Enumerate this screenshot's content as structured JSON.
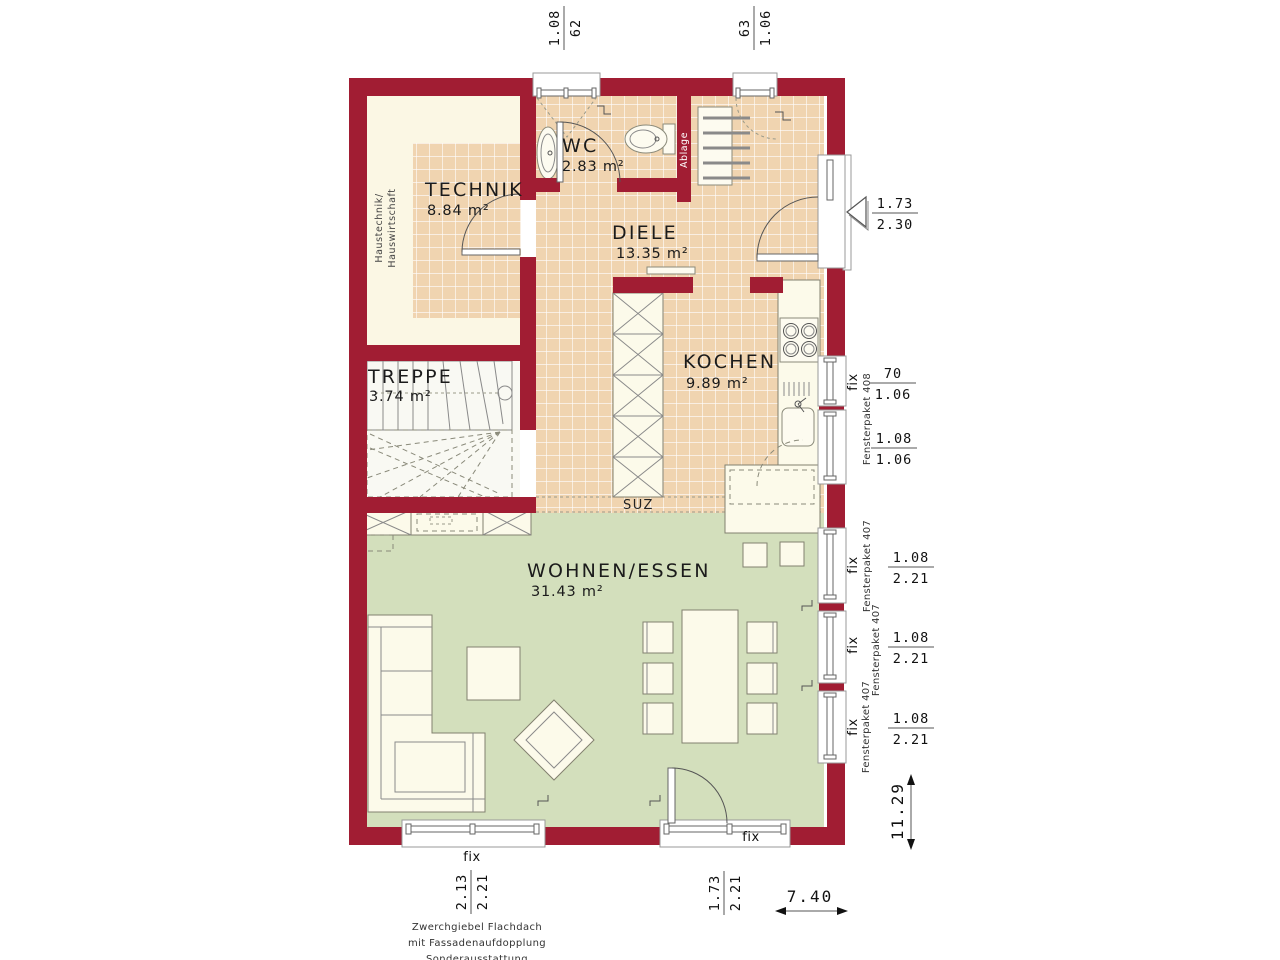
{
  "colors": {
    "wall": "#A11D33",
    "tile": "#F0D4B0",
    "tile_grid": "#FFFFFF",
    "living_floor": "#D3DFBC",
    "room_cream": "#FBF7E4",
    "furniture": "#FCFAEA",
    "text": "#1B1B1B"
  },
  "rooms": [
    {
      "name": "TECHNIK",
      "area": "8.84 m²"
    },
    {
      "name": "WC",
      "area": "2.83 m²"
    },
    {
      "name": "DIELE",
      "area": "13.35 m²"
    },
    {
      "name": "KOCHEN",
      "area": "9.89 m²"
    },
    {
      "name": "TREPPE",
      "area": "3.74 m²"
    },
    {
      "name": "WOHNEN/ESSEN",
      "area": "31.43 m²"
    }
  ],
  "labels": {
    "fix": "fix",
    "suz": "SUZ",
    "ablage": "Ablage",
    "haustechnik_line1": "Haustechnik/",
    "haustechnik_line2": "Hauswirtschaft",
    "fensterpaket_408": "Fensterpaket 408",
    "fensterpaket_407": "Fensterpaket 407"
  },
  "dims": {
    "top_window_left": {
      "a": "1.08",
      "b": "62"
    },
    "top_window_right": {
      "a": "63",
      "b": "1.06"
    },
    "entrance_door": {
      "a": "1.73",
      "b": "2.30"
    },
    "kitchen_window_upper": {
      "a": "70",
      "b": "1.06"
    },
    "kitchen_window_lower": {
      "a": "1.08",
      "b": "1.06"
    },
    "living_window": {
      "a": "1.08",
      "b": "2.21"
    },
    "bottom_window_left": {
      "a": "2.13",
      "b": "2.21"
    },
    "bottom_door": {
      "a": "1.73",
      "b": "2.21"
    },
    "overall_depth": "11.29",
    "overall_width": "7.40"
  },
  "footer": [
    "Zwerchgiebel Flachdach",
    "mit Fassadenaufdopplung",
    "Sonderausstattung"
  ]
}
